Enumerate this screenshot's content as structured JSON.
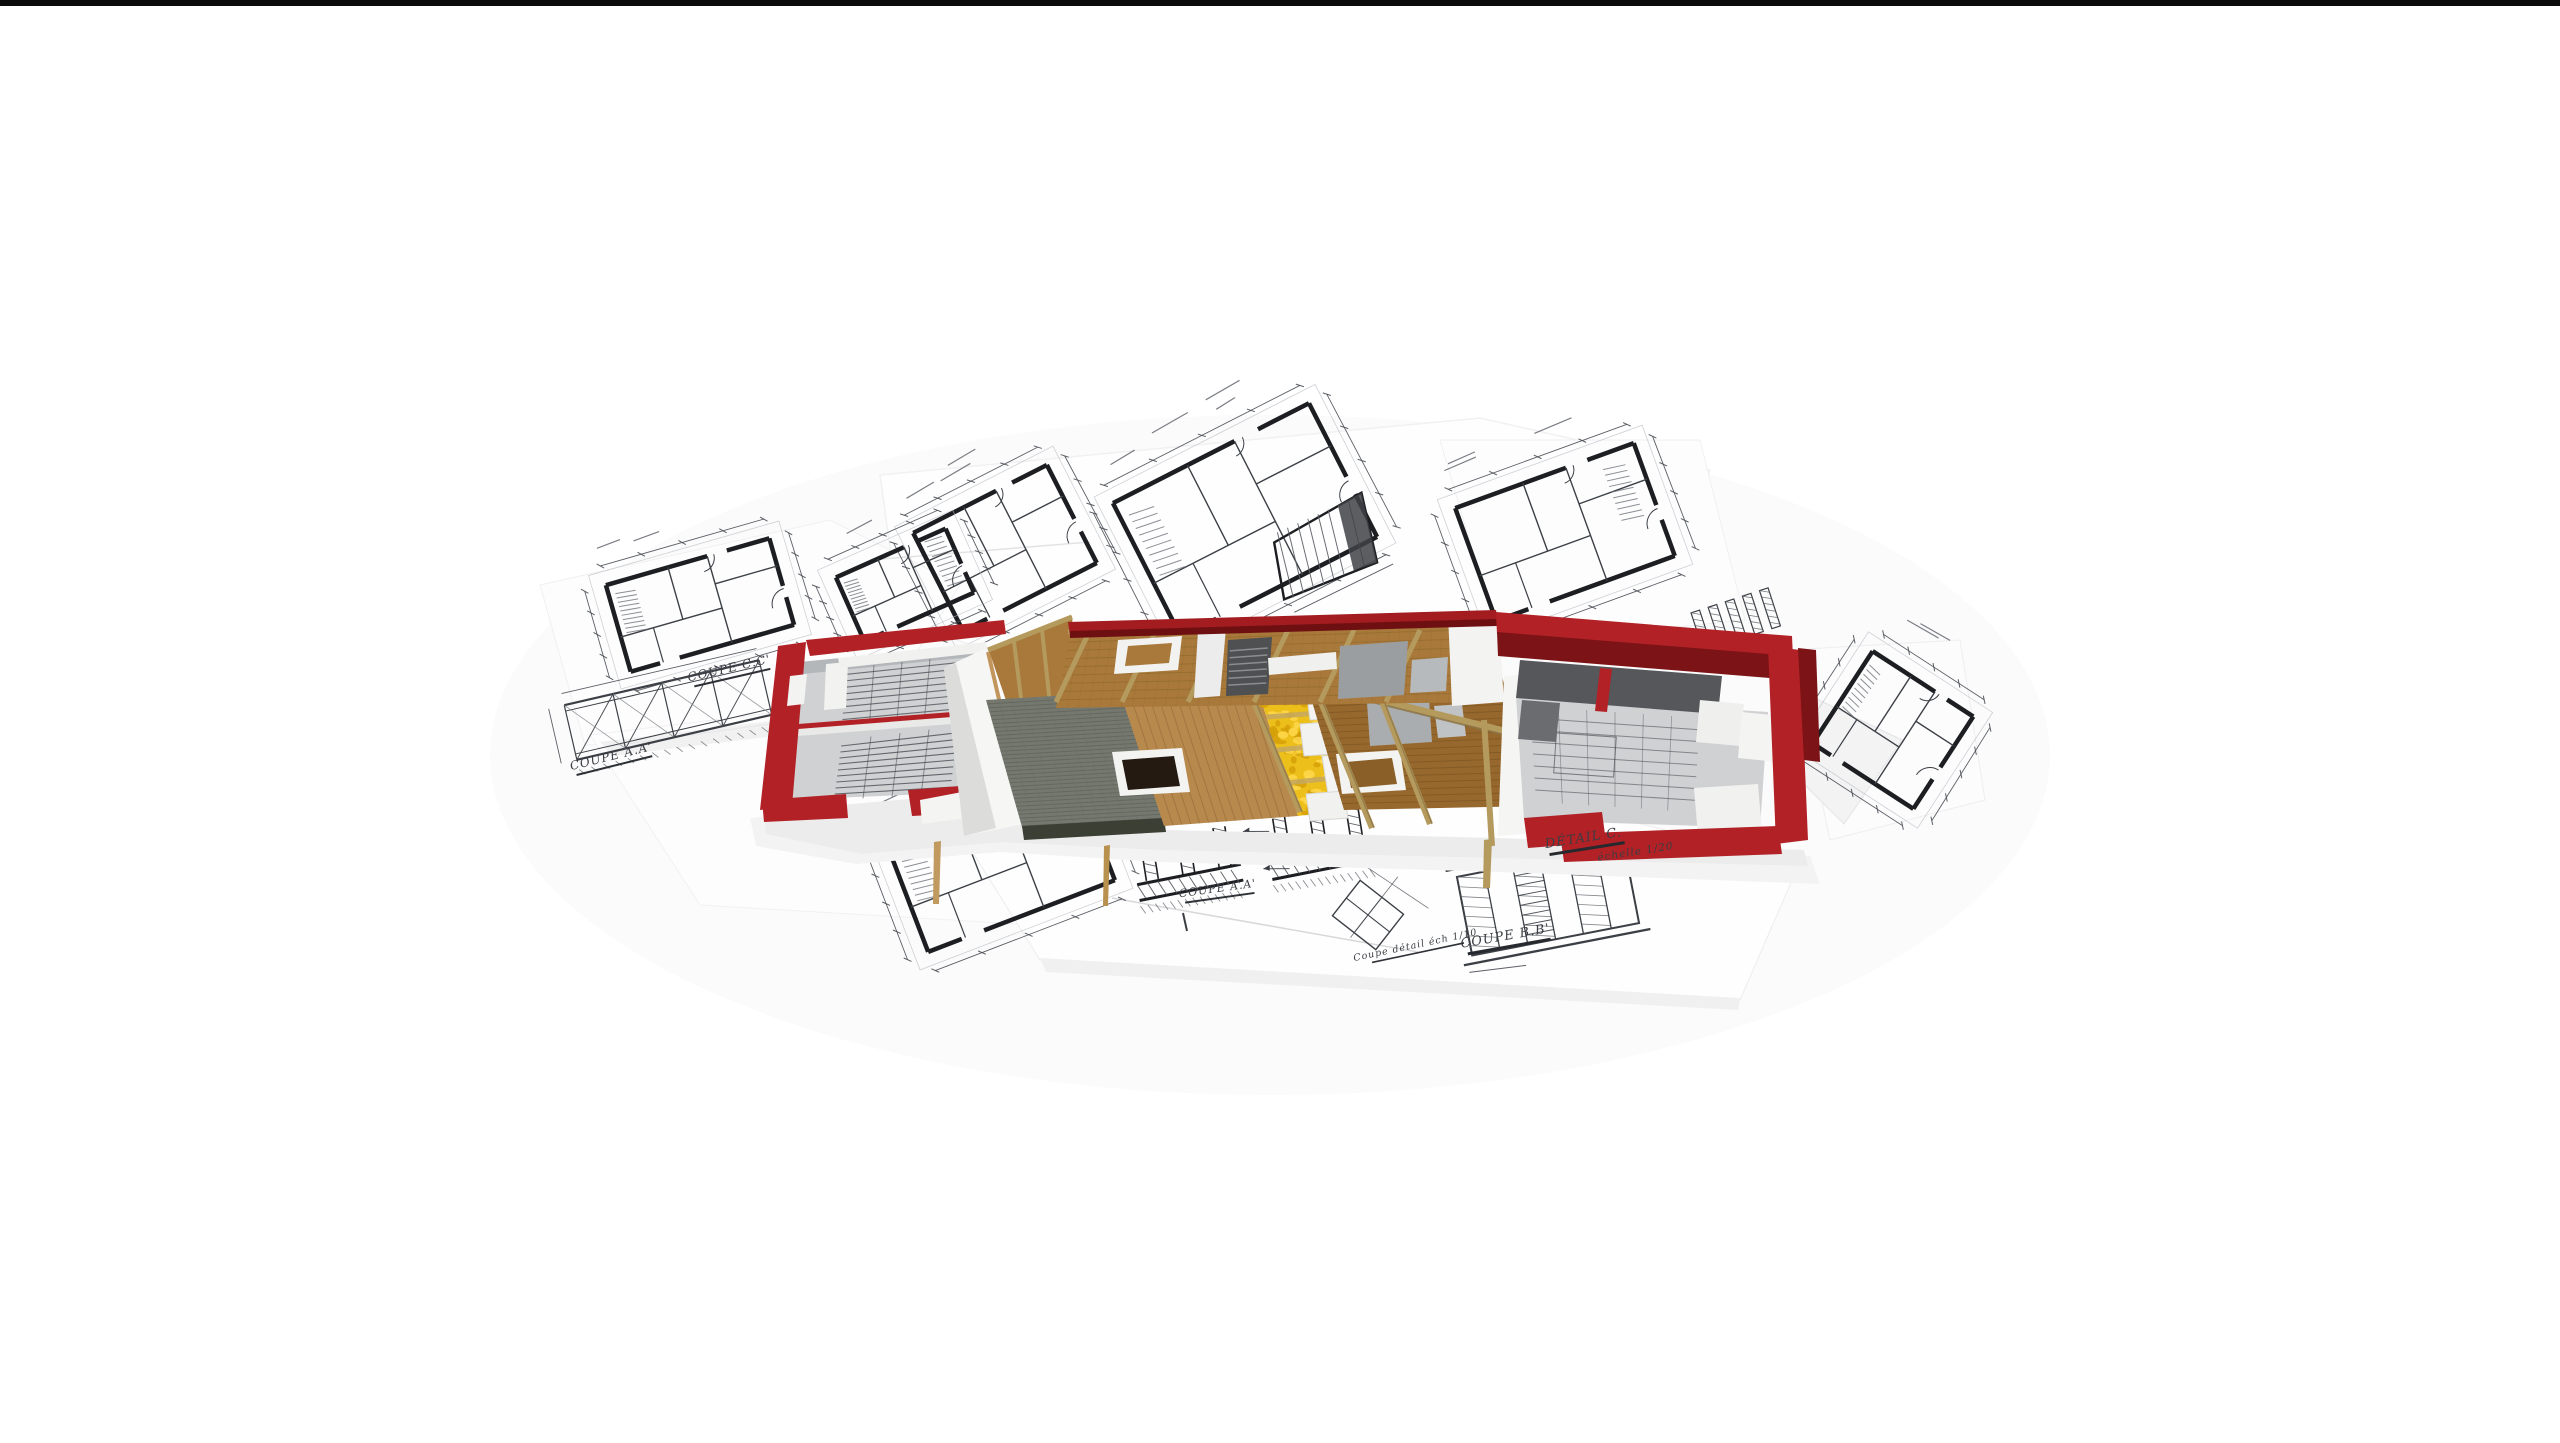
{
  "meta": {
    "description": "3D cutaway model of a house with red walls lying on a pile of architectural blueprint drawings, white background",
    "canvas": {
      "width": 2560,
      "height": 1443
    },
    "background": "#ffffff",
    "top_bar_color": "#0b0b0b"
  },
  "palette": {
    "wall_red": "#b22125",
    "wall_red_dark": "#7c1316",
    "ridge_red": "#a31c20",
    "tile_gray": "#75786f",
    "tile_seam": "#585b52",
    "tile_fascia": "#3c3f34",
    "sheathing_wood": "#b8894d",
    "attic_wood": "#a8793b",
    "floor_wood_dark": "#97682d",
    "insulation_yellow": "#edbf1b",
    "insulation_light": "#ffd94f",
    "insulation_deep": "#d39f06",
    "beam_tan": "#b59a5e",
    "interior_gray": "#cfd1d3",
    "interior_gray_dark": "#55575a",
    "white_wall": "#f4f4f2",
    "paper": "#fdfdfd",
    "paper_edge": "#e4e4e6",
    "ink": "#1c1e22",
    "ink_thin": "#3c4046",
    "ink_faint": "#8a8d93",
    "shadow": "#ececec"
  },
  "labels": [
    {
      "id": "coupe-cc",
      "text": "COUPE C.C'"
    },
    {
      "id": "coupe-aa-left",
      "text": "COUPE A.A'"
    },
    {
      "id": "coupe-aa-center",
      "text": "COUPE A.A'"
    },
    {
      "id": "detail-c",
      "text": "DÉTAIL C."
    },
    {
      "id": "echelle",
      "text": "échelle 1/20"
    },
    {
      "id": "coupe-bb",
      "text": "COUPE B.B'"
    },
    {
      "id": "coupe-detail",
      "text": "Coupe détail éch 1/10"
    }
  ],
  "scene": {
    "model_parts": [
      {
        "name": "left-room-block",
        "material": "red masonry walls, gray interior with stair sketches"
      },
      {
        "name": "gable-end-wall",
        "material": "white plaster"
      },
      {
        "name": "roof-tile-band",
        "material": "gray tiles"
      },
      {
        "name": "roof-sheathing-band",
        "material": "light wood planks with skylight"
      },
      {
        "name": "roof-insulation-band",
        "material": "yellow mineral insulation with white panels"
      },
      {
        "name": "attic-floor",
        "material": "wood boards, rafter beams, ridge in red"
      },
      {
        "name": "right-room-block",
        "material": "red masonry walls, gray interior, white doors"
      }
    ],
    "blueprints": [
      "floor-plan-top-left",
      "floor-plan-top-center",
      "roof-framing-plan",
      "floor-plan-top-right",
      "floor-plan-right",
      "rounded-plan-left",
      "truss-section-left",
      "floor-plan-bottom-left",
      "foundation-section-center",
      "ladder-section-bottom-right",
      "small-diamond-plan"
    ]
  }
}
